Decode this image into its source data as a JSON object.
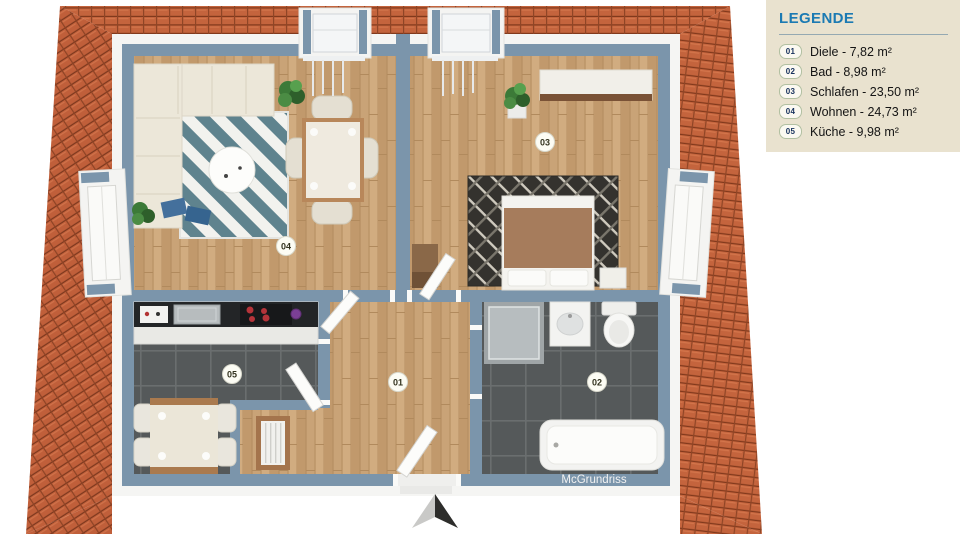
{
  "legend": {
    "title": "LEGENDE",
    "items": [
      {
        "id": "01",
        "label": "Diele - 7,82 m²"
      },
      {
        "id": "02",
        "label": "Bad - 8,98 m²"
      },
      {
        "id": "03",
        "label": "Schlafen - 23,50 m²"
      },
      {
        "id": "04",
        "label": "Wohnen - 24,73 m²"
      },
      {
        "id": "05",
        "label": "Küche - 9,98 m²"
      }
    ]
  },
  "plan": {
    "watermark": "McGrundriss",
    "room_markers": [
      {
        "id": "01",
        "room": "Diele"
      },
      {
        "id": "02",
        "room": "Bad"
      },
      {
        "id": "03",
        "room": "Schlafen"
      },
      {
        "id": "04",
        "room": "Wohnen"
      },
      {
        "id": "05",
        "room": "Küche"
      }
    ],
    "colors": {
      "roof": "#c4643d",
      "wall": "#7b95ab",
      "wood_floor": "#c9a377",
      "tile_floor": "#55595a",
      "legend_bg": "#e9e2cf",
      "legend_title": "#1b7ab3"
    }
  }
}
